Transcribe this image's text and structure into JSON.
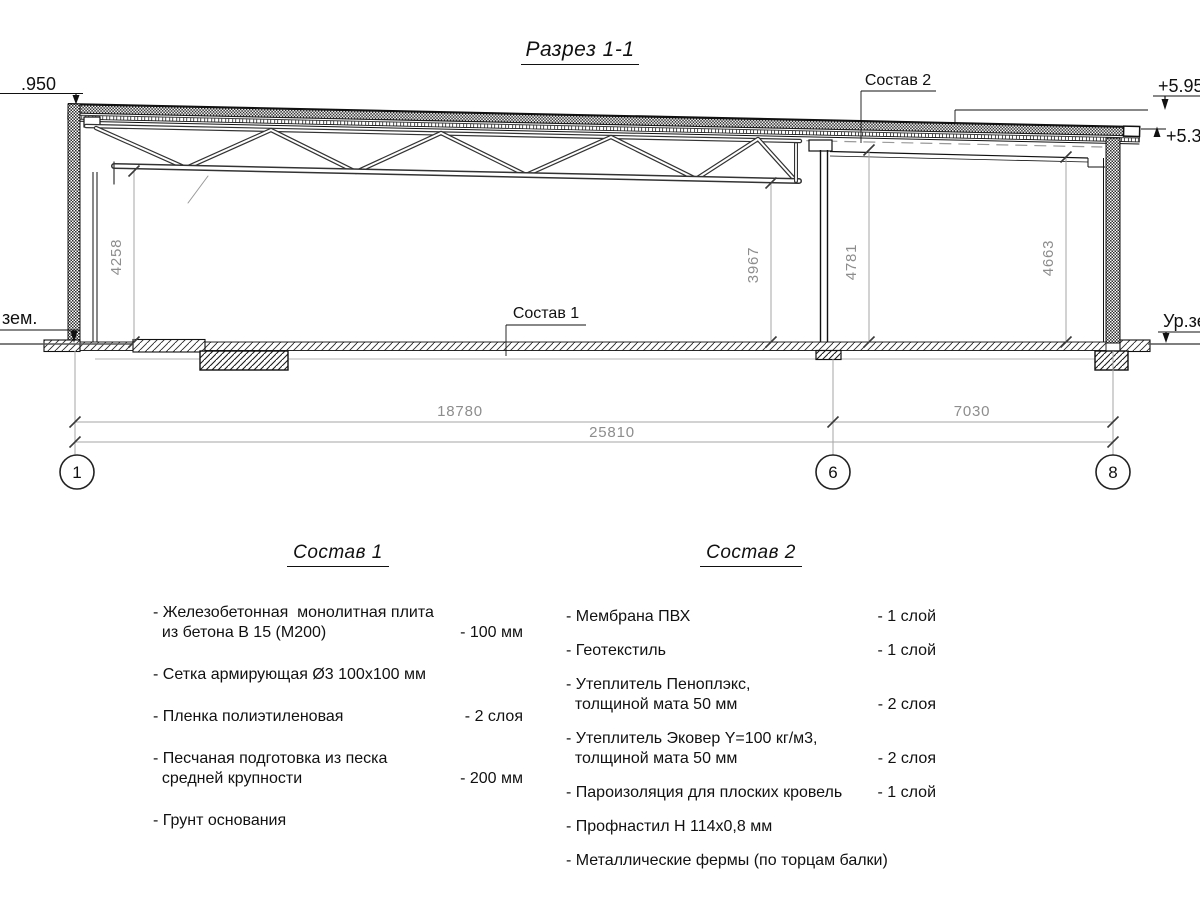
{
  "title": "Разрез 1-1",
  "drawing": {
    "elevation_left": ".950",
    "elevation_right_top": "+5.95",
    "elevation_right_mid": "+5.38",
    "ground_label_left": "зем.",
    "ground_label_right": "Ур.зе",
    "callout_sostav1": "Состав 1",
    "callout_sostav2": "Состав 2",
    "vdims": {
      "v1": "4258",
      "v2": "3967",
      "v3": "4781",
      "v4": "4663"
    },
    "hdims": {
      "d1": "18780",
      "d2": "7030",
      "total": "25810"
    },
    "bubbles": {
      "b1": "1",
      "b6": "6",
      "b8": "8"
    }
  },
  "lists": [
    {
      "heading": "Состав 1",
      "items": [
        {
          "lines": [
            "- Железобетонная  монолитная плита",
            "  из бетона В 15 (М200)"
          ],
          "value": "- 100 мм"
        },
        {
          "lines": [
            "- Сетка армирующая Ø3 100х100 мм"
          ]
        },
        {
          "lines": [
            "- Пленка полиэтиленовая"
          ],
          "value": "-  2 слоя"
        },
        {
          "lines": [
            "- Песчаная подготовка из песка",
            "  средней крупности"
          ],
          "value": "- 200 мм"
        },
        {
          "lines": [
            "- Грунт основания"
          ]
        }
      ]
    },
    {
      "heading": "Состав 2",
      "items": [
        {
          "lines": [
            "- Мембрана ПВХ"
          ],
          "value": "- 1 слой"
        },
        {
          "lines": [
            "- Геотекстиль"
          ],
          "value": "- 1 слой"
        },
        {
          "lines": [
            "- Утеплитель Пеноплэкс,",
            "  толщиной мата 50 мм"
          ],
          "value": "- 2 слоя"
        },
        {
          "lines": [
            "- Утеплитель Эковер Y=100 кг/м3,",
            "  толщиной мата 50 мм"
          ],
          "value": "- 2 слоя"
        },
        {
          "lines": [
            "- Пароизоляция для плоских кровель"
          ],
          "value": "- 1 слой"
        },
        {
          "lines": [
            "- Профнастил Н 114х0,8 мм"
          ]
        },
        {
          "lines": [
            "- Металлические фермы (по торцам балки)"
          ]
        }
      ]
    }
  ]
}
